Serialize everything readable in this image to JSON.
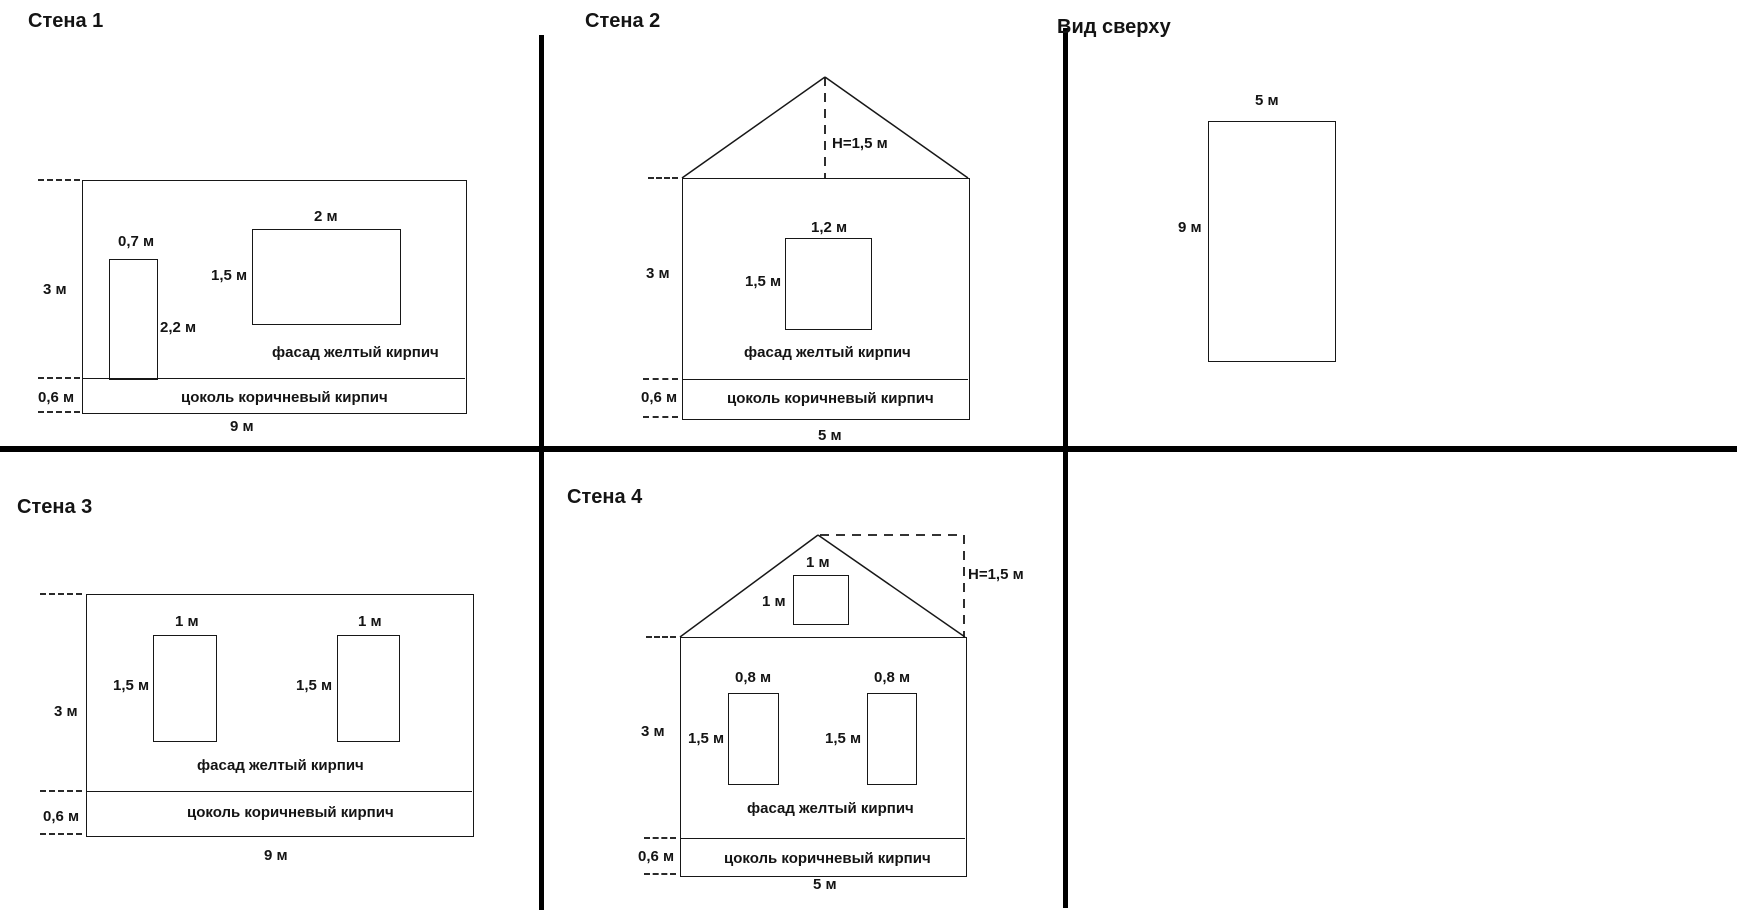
{
  "panels": {
    "wall1": {
      "title": "Стена 1",
      "dim_height": "3 м",
      "dim_plinth": "0,6 м",
      "dim_width": "9 м",
      "door": {
        "width": "0,7 м",
        "height": "2,2 м"
      },
      "window": {
        "width": "2 м",
        "height": "1,5 м"
      },
      "facade": "фасад желтый кирпич",
      "plinth": "цоколь коричневый кирпич"
    },
    "wall2": {
      "title": "Стена 2",
      "roof_height": "Н=1,5 м",
      "dim_height": "3 м",
      "dim_plinth": "0,6 м",
      "dim_width": "5 м",
      "window": {
        "width": "1,2 м",
        "height": "1,5 м"
      },
      "facade": "фасад желтый кирпич",
      "plinth": "цоколь коричневый кирпич"
    },
    "topview": {
      "title": "Вид сверху",
      "dim_width": "5 м",
      "dim_depth": "9 м"
    },
    "wall3": {
      "title": "Стена 3",
      "dim_height": "3 м",
      "dim_plinth": "0,6 м",
      "dim_width": "9 м",
      "window_left": {
        "width": "1 м",
        "height": "1,5 м"
      },
      "window_right": {
        "width": "1 м",
        "height": "1,5 м"
      },
      "facade": "фасад желтый кирпич",
      "plinth": "цоколь коричневый кирпич"
    },
    "wall4": {
      "title": "Стена 4",
      "roof_height": "Н=1,5 м",
      "attic_window": {
        "width": "1 м",
        "height": "1 м"
      },
      "dim_height": "3 м",
      "dim_plinth": "0,6 м",
      "dim_width": "5 м",
      "window_left": {
        "width": "0,8 м",
        "height": "1,5 м"
      },
      "window_right": {
        "width": "0,8 м",
        "height": "1,5 м"
      },
      "facade": "фасад желтый кирпич",
      "plinth": "цоколь коричневый кирпич"
    },
    "colors": {
      "line": "#171717",
      "divider": "#000000",
      "background": "#ffffff"
    }
  }
}
